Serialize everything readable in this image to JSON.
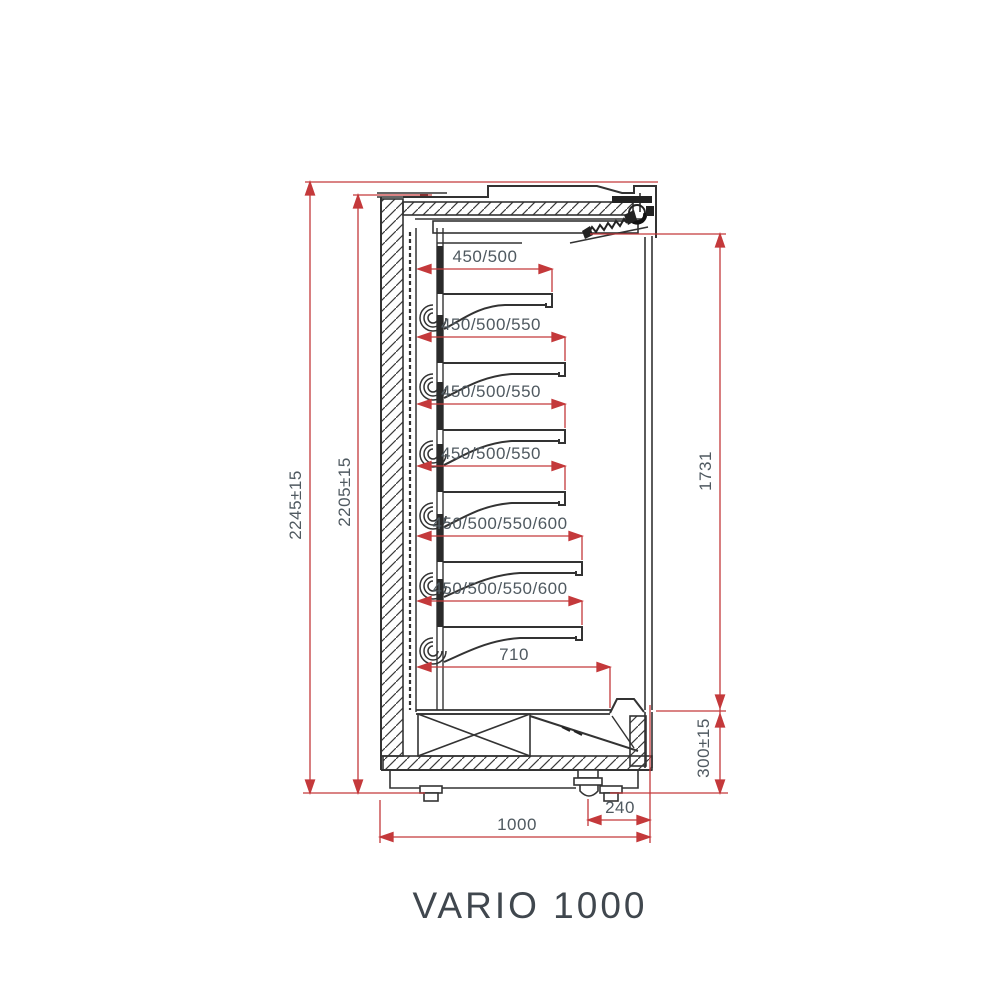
{
  "title": "VARIO 1000",
  "dimensions": {
    "overall_height": "2245±15",
    "body_height": "2205±15",
    "opening_height": "1731",
    "plinth_height": "300±15",
    "total_depth": "1000",
    "rear_base_depth": "240",
    "bottom_deck_depth": "710",
    "shelf_depths": [
      "450/500",
      "450/500/550",
      "450/500/550",
      "450/500/550",
      "450/500/550/600",
      "450/500/550/600"
    ]
  },
  "colors": {
    "dimension_line": "#c4393b",
    "drawing_line": "#333333",
    "dimension_text": "#4f5960",
    "title_text": "#40474e",
    "background": "#ffffff"
  }
}
